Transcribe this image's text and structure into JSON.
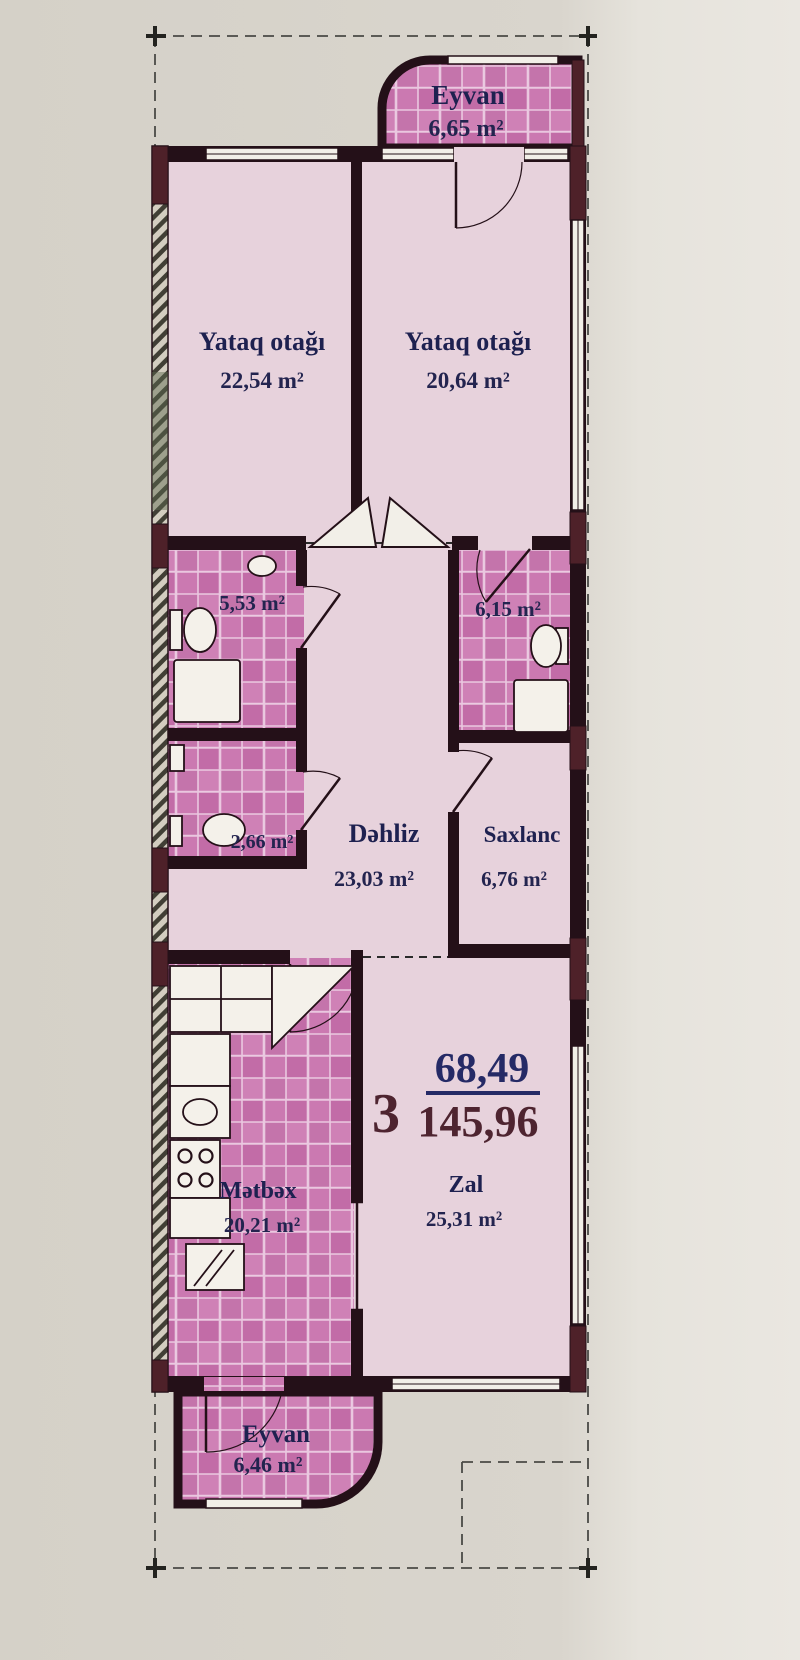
{
  "document": {
    "type": "apartment floor plan",
    "language": "Azerbaijani"
  },
  "rooms": {
    "eyvan_top": {
      "name": "Eyvan",
      "area": "6,65 m²"
    },
    "yataq1": {
      "name": "Yataq otağı",
      "area": "22,54 m²"
    },
    "yataq2": {
      "name": "Yataq otağı",
      "area": "20,64 m²"
    },
    "bath1": {
      "name": "bathroom",
      "area": "5,53 m²"
    },
    "bath2": {
      "name": "bathroom",
      "area": "6,15 m²"
    },
    "wc": {
      "name": "wc",
      "area": "2,66 m²"
    },
    "dehliz": {
      "name": "Dəhliz",
      "area": "23,03 m²"
    },
    "saxlanc": {
      "name": "Saxlanc",
      "area": "6,76 m²"
    },
    "metbex": {
      "name": "Mətbəx",
      "area": "20,21 m²"
    },
    "zal": {
      "name": "Zal",
      "area": "25,31 m²"
    },
    "eyvan_bottom": {
      "name": "Eyvan",
      "area": "6,46 m²"
    }
  },
  "summary": {
    "room_count": "3",
    "living_area": "68,49",
    "total_area": "145,96"
  },
  "colors": {
    "paper": "#d9d5cd",
    "paper_light": "#eae7e1",
    "room_pink": "#e7d2dc",
    "tile_pink": "#c873ac",
    "wall_dark": "#241018",
    "wall_maroon": "#4e2129",
    "label_navy": "#1e2150",
    "accent_navy": "#252a66",
    "accent_maroon": "#4e2430"
  }
}
